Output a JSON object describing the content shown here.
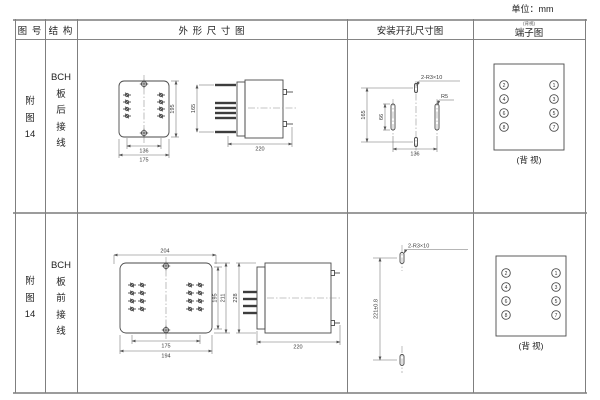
{
  "unit_note": "单位：mm",
  "table": {
    "header": {
      "fig": "图 号",
      "structure": "结 构",
      "outline": "外 形 尺 寸 图",
      "install": "安装开孔尺寸图",
      "terminal": "端子图",
      "terminal_note": "(背视)"
    },
    "rows": [
      {
        "fig_lines": [
          "附",
          "图",
          "14"
        ],
        "structure_lines": [
          "BCH",
          "板",
          "后",
          "接",
          "线"
        ],
        "outline": {
          "front_width_inner": "136",
          "front_width_outer": "175",
          "front_height": "195",
          "terminal_span": "165",
          "depth": "220"
        },
        "install": {
          "slot_label": "2-R3×10",
          "corner_label": "R5",
          "height": "165",
          "slot_length": "66",
          "width": "136"
        },
        "terminal": {
          "left_terminals": [
            "2",
            "4",
            "6",
            "8"
          ],
          "right_terminals": [
            "1",
            "3",
            "5",
            "7"
          ],
          "caption": "(背 视)"
        }
      },
      {
        "fig_lines": [
          "附",
          "图",
          "14"
        ],
        "structure_lines": [
          "BCH",
          "板",
          "前",
          "接",
          "线"
        ],
        "outline": {
          "front_width_top": "204",
          "front_height_inner": "195",
          "front_height_outer": "211",
          "front_width_inner": "175",
          "front_width_outer": "194",
          "side_height": "228",
          "depth": "220"
        },
        "install": {
          "slot_label": "2-R3×10",
          "height": "221±0.8"
        },
        "terminal": {
          "left_terminals": [
            "2",
            "4",
            "6",
            "8"
          ],
          "right_terminals": [
            "1",
            "3",
            "5",
            "7"
          ],
          "caption": "(背 视)"
        }
      }
    ]
  }
}
